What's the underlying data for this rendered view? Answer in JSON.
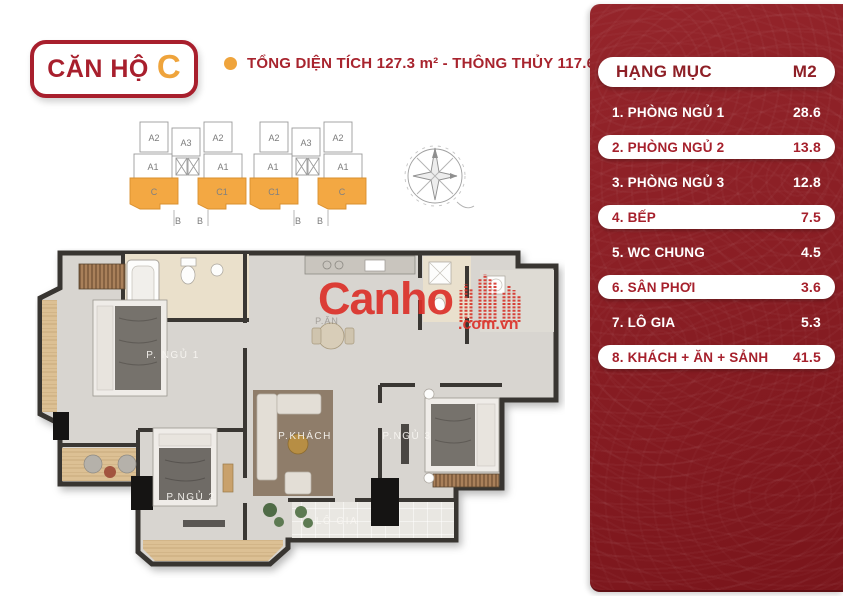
{
  "badge": {
    "title": "CĂN HỘ",
    "unit": "C"
  },
  "subtitle": {
    "text": "TỔNG DIỆN TÍCH 127.3 m² - THÔNG THỦY 117.6 m²"
  },
  "key_plan": {
    "wing1": [
      "A2",
      "A3",
      "A2",
      "A1",
      "A1",
      "C",
      "C1",
      "B",
      "B"
    ],
    "wing2": [
      "A2",
      "A3",
      "A2",
      "A1",
      "A1",
      "C1",
      "C",
      "B",
      "B"
    ]
  },
  "floor_plan": {
    "rooms": {
      "bedroom1": "P. NGỦ 1",
      "bedroom2": "P.NGỦ 2",
      "bedroom3": "P.NGỦ 3",
      "living": "P.KHÁCH",
      "dining": "P.ĂN",
      "loggia": "LÔ GIA"
    }
  },
  "watermark": {
    "brand": "Canho",
    "domain": ".com.vn"
  },
  "table": {
    "header": {
      "label": "HẠNG MỤC",
      "unit": "M2"
    },
    "rows": [
      {
        "label": "1. PHÒNG NGỦ 1",
        "value": "28.6",
        "highlight": false
      },
      {
        "label": "2. PHÒNG NGỦ 2",
        "value": "13.8",
        "highlight": true
      },
      {
        "label": "3. PHÒNG NGỦ 3",
        "value": "12.8",
        "highlight": false
      },
      {
        "label": "4. BẾP",
        "value": "7.5",
        "highlight": true
      },
      {
        "label": "5. WC CHUNG",
        "value": "4.5",
        "highlight": false
      },
      {
        "label": "6. SÂN PHƠI",
        "value": "3.6",
        "highlight": true
      },
      {
        "label": "7. LÔ GIA",
        "value": "5.3",
        "highlight": false
      },
      {
        "label": "8. KHÁCH + ĂN + SẢNH",
        "value": "41.5",
        "highlight": true
      }
    ]
  },
  "colors": {
    "panel_red": "#891E24",
    "badge_red": "#A81F2D",
    "accent_orange": "#EFA43C",
    "wall": "#383531",
    "floor": "#D8D5D0",
    "wood": "#DCC094",
    "watermark_red": "#DC3129"
  }
}
